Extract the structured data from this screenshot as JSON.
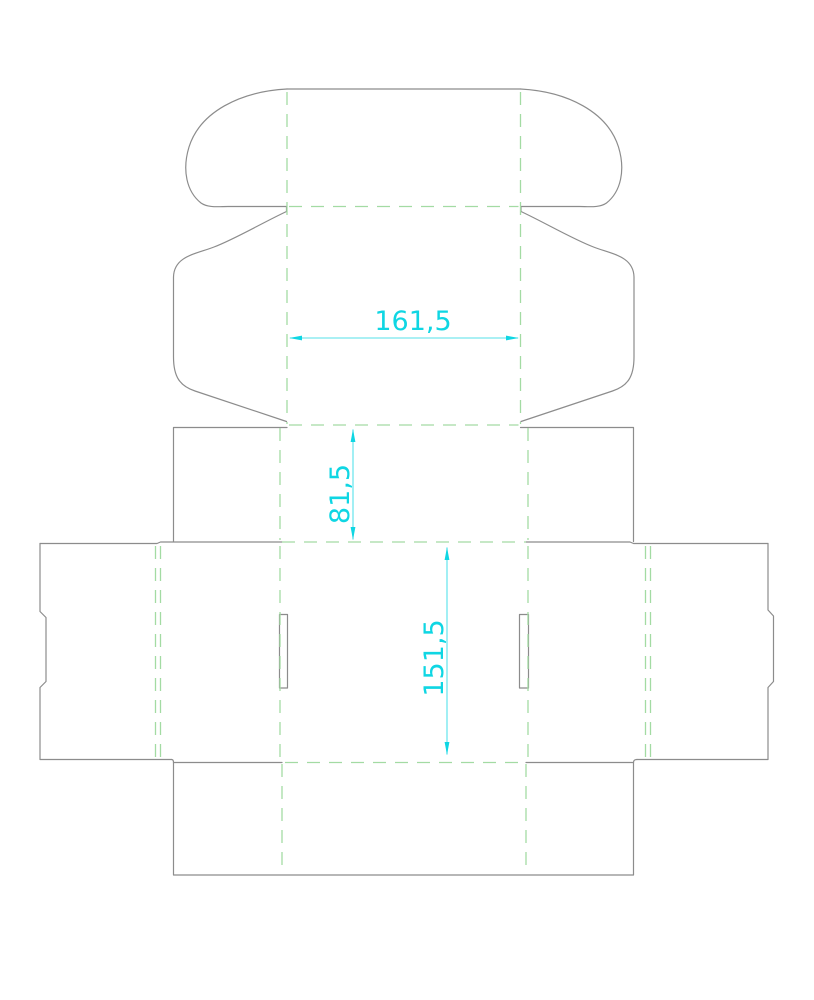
{
  "document": {
    "title": "box-dieline-drawing",
    "description_label": "Corrugated box dieline with tuck flap, dust wings, slots and fold lines"
  },
  "styles": {
    "background": "#ffffff",
    "cut_color": "#8c8c8c",
    "fold_color": "#a3dba3",
    "dimension_text_color": "#0fd6e3",
    "dimension_line_color": "#55e2ea"
  },
  "dimensions": [
    {
      "id": "lid-width",
      "label": "161,5",
      "value": 161.5,
      "orientation": "horizontal",
      "measures": "lid panel width"
    },
    {
      "id": "front-depth",
      "label": "81,5",
      "value": 81.5,
      "orientation": "vertical",
      "measures": "front panel height"
    },
    {
      "id": "body-length",
      "label": "151,5",
      "value": 151.5,
      "orientation": "vertical",
      "measures": "main body panel height"
    }
  ]
}
